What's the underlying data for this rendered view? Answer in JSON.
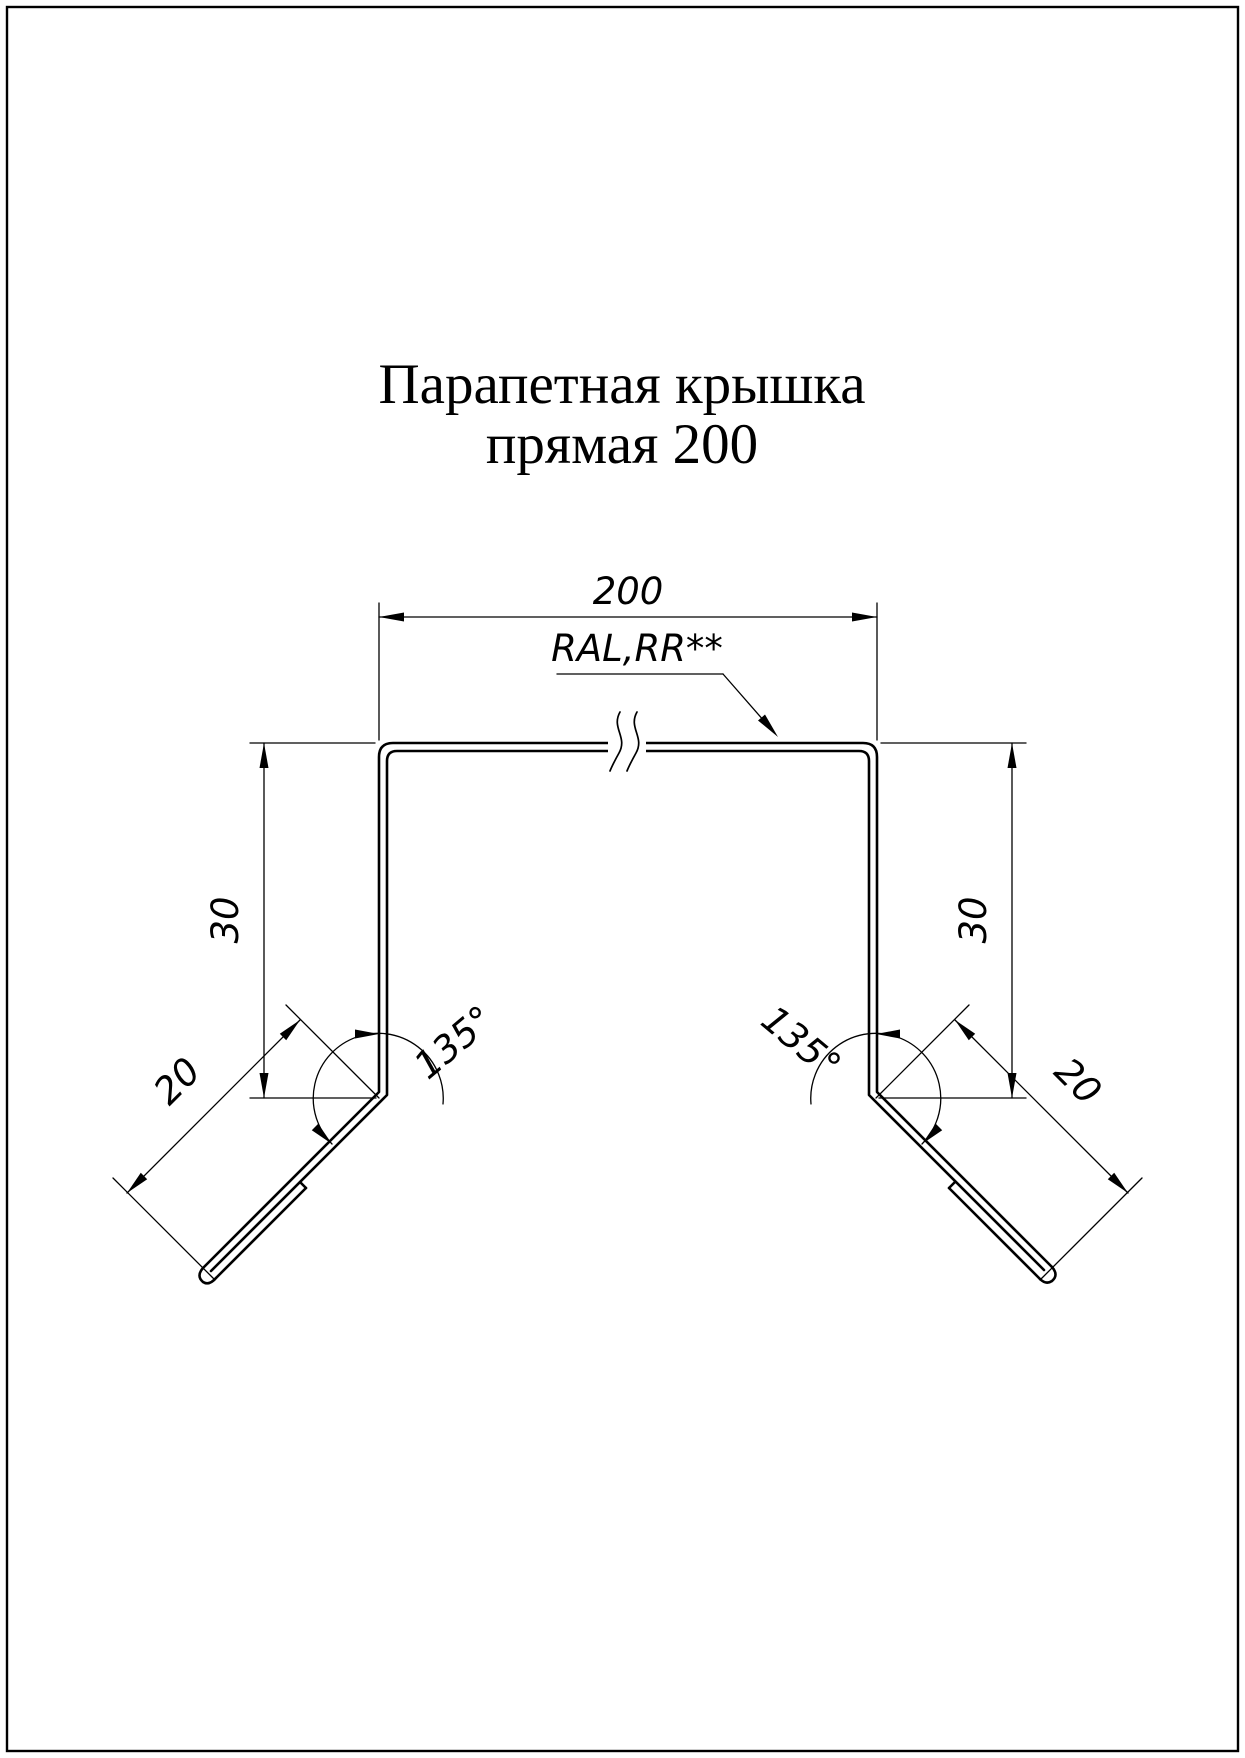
{
  "page": {
    "background_color": "#ffffff",
    "line_color": "#000000"
  },
  "title": {
    "line1": "Парапетная крышка",
    "line2": "прямая 200"
  },
  "annotations": {
    "coating_label": "RAL,RR**"
  },
  "dimensions": {
    "top_width": "200",
    "left_height": "30",
    "right_height": "30",
    "left_flange_length": "20",
    "right_flange_length": "20",
    "left_bend_angle": "135°",
    "right_bend_angle": "135°"
  }
}
